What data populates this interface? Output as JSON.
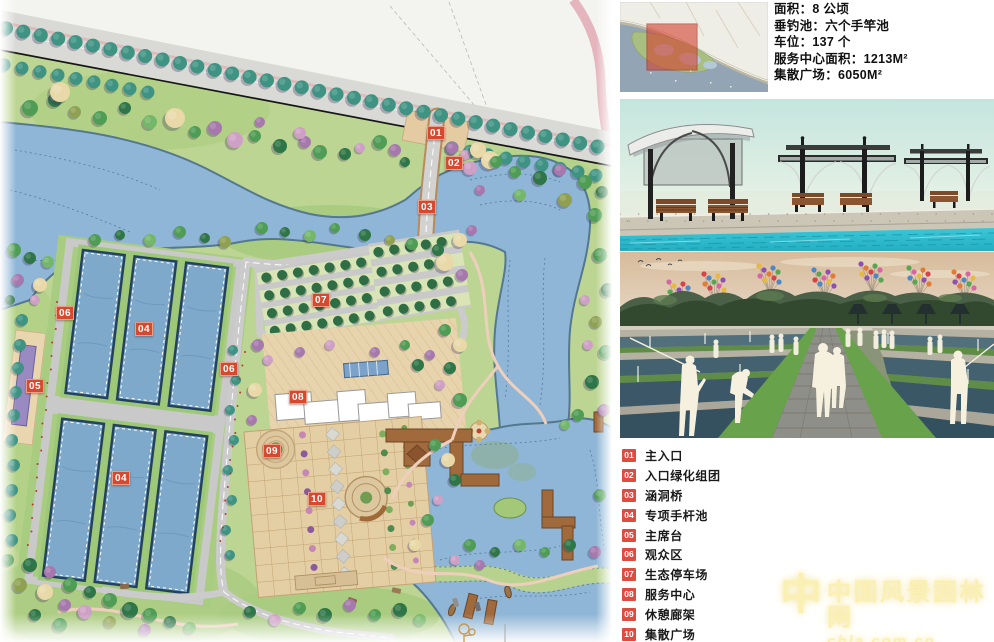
{
  "panel": {
    "info": {
      "lines": [
        "面积：8 公顷",
        "垂钓池：六个手竿池",
        "车位：137 个",
        "服务中心面积：1213M²",
        "集散广场：6050M²"
      ]
    }
  },
  "legend": {
    "items": [
      {
        "num": "01",
        "label": "主入口"
      },
      {
        "num": "02",
        "label": "入口绿化组团"
      },
      {
        "num": "03",
        "label": "涵洞桥"
      },
      {
        "num": "04",
        "label": "专项手杆池"
      },
      {
        "num": "05",
        "label": "主席台"
      },
      {
        "num": "06",
        "label": "观众区"
      },
      {
        "num": "07",
        "label": "生态停车场"
      },
      {
        "num": "08",
        "label": "服务中心"
      },
      {
        "num": "09",
        "label": "休憩廊架"
      },
      {
        "num": "10",
        "label": "集散广场"
      }
    ]
  },
  "plan": {
    "markers": [
      {
        "label": "01"
      },
      {
        "label": "02"
      },
      {
        "label": "03"
      },
      {
        "label": "04"
      },
      {
        "label": "04"
      },
      {
        "label": "05"
      },
      {
        "label": "06"
      },
      {
        "label": "06"
      },
      {
        "label": "07"
      },
      {
        "label": "08"
      },
      {
        "label": "09"
      },
      {
        "label": "10"
      }
    ]
  },
  "watermark": {
    "logo": "中",
    "title": "中国风景园林网",
    "url": "chla.com.cn"
  },
  "colors": {
    "marker": "#d5492f",
    "water": "#7ea9cb",
    "plaza": "#e4cfa4",
    "lake": "#8fb6d6"
  }
}
